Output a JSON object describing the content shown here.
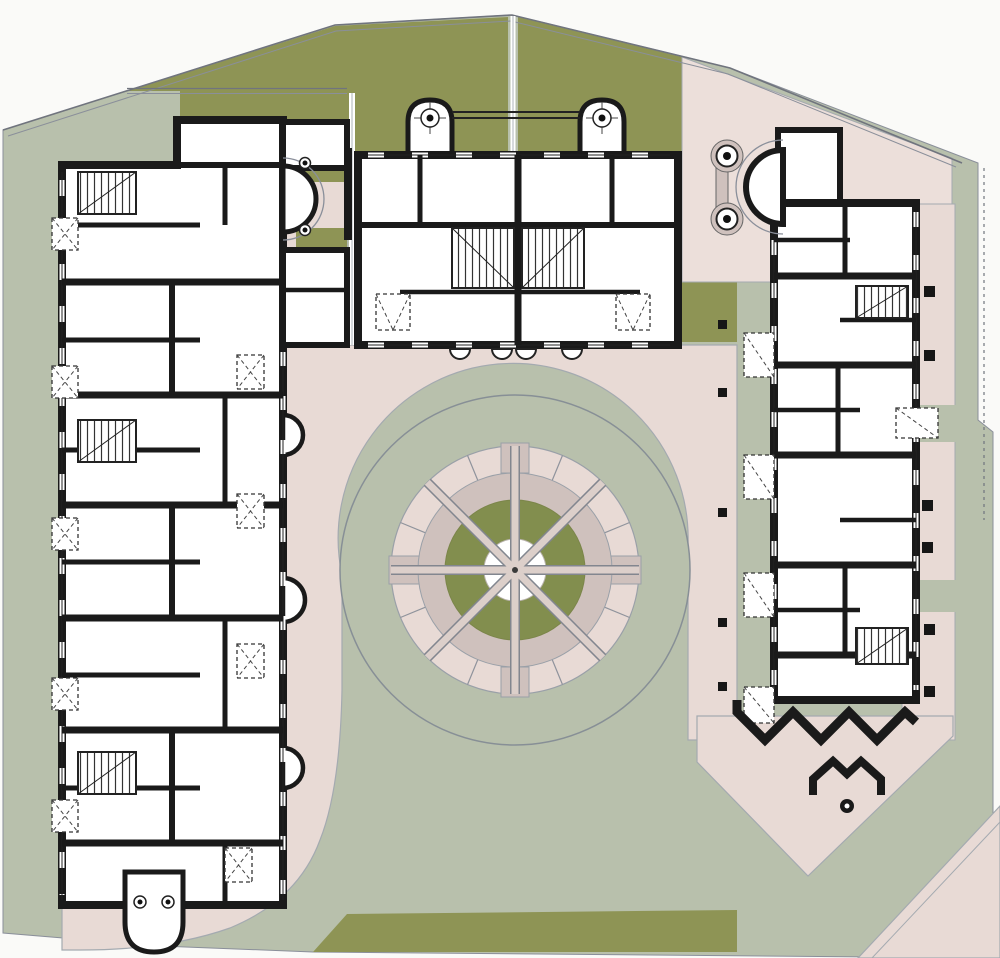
{
  "drawing": {
    "type": "architectural-site-plan",
    "description": "Ground floor site plan of a residential complex: three building wings around a landscaped courtyard with a circular fountain garden",
    "visible_text": []
  },
  "colors": {
    "paper": "#fafaf8",
    "sage": "#b8c0ac",
    "olive": "#8e9455",
    "olive_dark": "#828e4e",
    "pink": "#e8dad5",
    "pink_light": "#ecdfda",
    "mauve": "#cfc1bd",
    "wall": "#1a1a1a",
    "line": "#8a8f9a",
    "white": "#ffffff"
  },
  "site": {
    "areas": [
      {
        "name": "lawn-north-band",
        "surface": "grass"
      },
      {
        "name": "lawn-north-center",
        "surface": "grass"
      },
      {
        "name": "lawn-nook-west",
        "surface": "grass"
      },
      {
        "name": "lawn-patch-east",
        "surface": "grass"
      },
      {
        "name": "lawn-south-trapezoid",
        "surface": "grass"
      },
      {
        "name": "courtyard-ground",
        "surface": "sage-ground"
      },
      {
        "name": "courtyard-pavement",
        "surface": "paved-pink"
      },
      {
        "name": "entry-court-northeast",
        "surface": "paved-pink"
      },
      {
        "name": "terrace-strip-east",
        "surface": "paved-pink"
      },
      {
        "name": "plaza-diamond-southeast",
        "surface": "paved-pink"
      },
      {
        "name": "path-corner-southeast",
        "surface": "paved-pink"
      },
      {
        "name": "nook-court-west",
        "surface": "paved-pink"
      }
    ]
  },
  "fountain": {
    "cx": 515,
    "cy": 570,
    "radii": {
      "courtyard_circle": 175,
      "paved_ring": 124,
      "inner_ring": 97,
      "lawn_disc": 70,
      "center_disc": 31
    },
    "spoke_count": 8,
    "cardinal_blocks": 4
  },
  "buildings": [
    {
      "name": "west-wing",
      "features": [
        "three stair cores",
        "east bay windows",
        "apse bay",
        "south porch with two columns",
        "dashed service shafts"
      ]
    },
    {
      "name": "north-block",
      "features": [
        "two round-top roof towers with finials",
        "central twin stair hall",
        "four entry steps",
        "two service shafts"
      ]
    },
    {
      "name": "east-wing",
      "features": [
        "horseshoe entry bay with two columns",
        "two stair cores",
        "east terraces with posts",
        "south zigzag wall",
        "chevron garden wall with column"
      ]
    }
  ]
}
